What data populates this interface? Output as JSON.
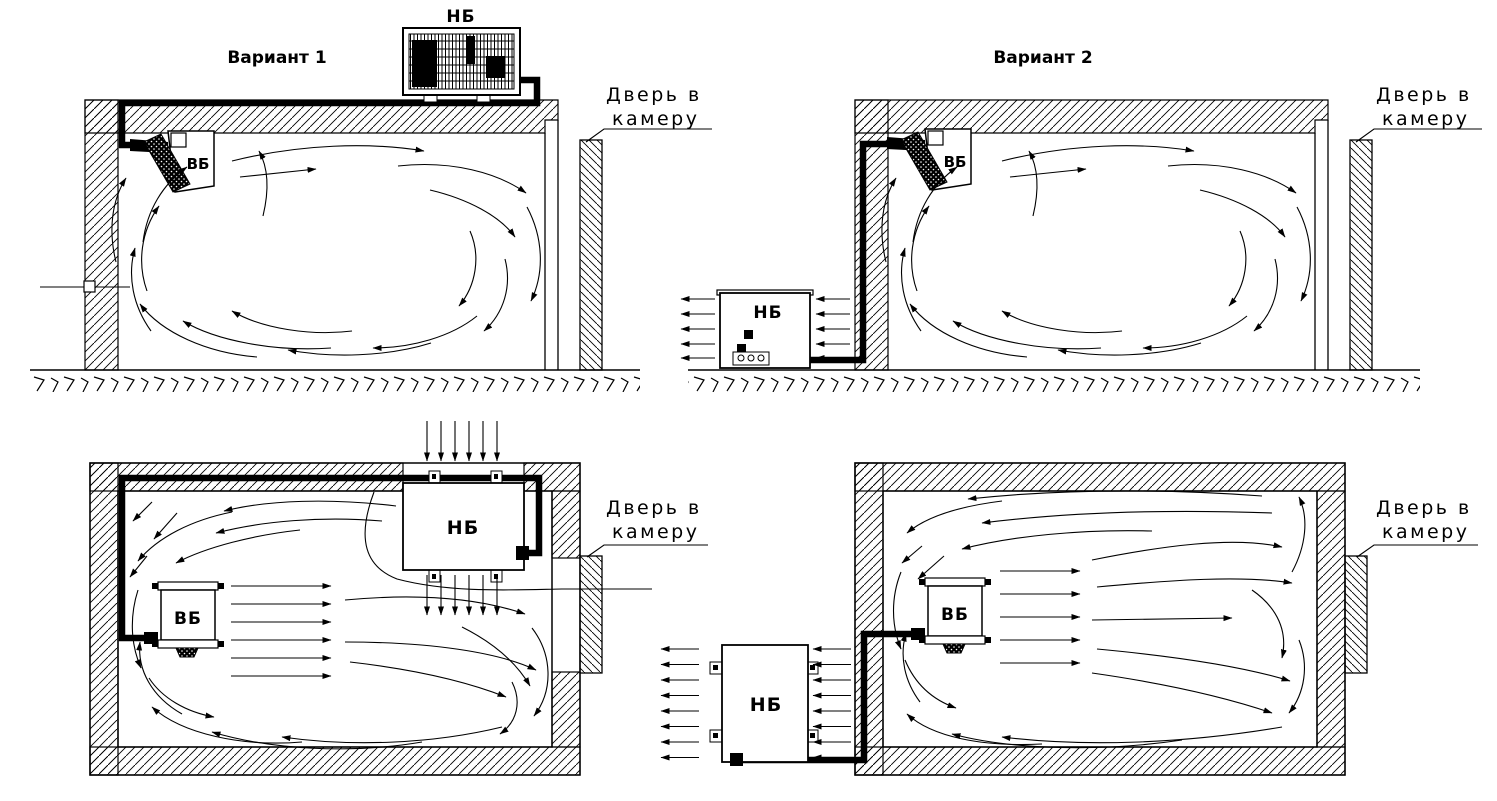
{
  "canvas": {
    "background": "#ffffff",
    "line_color": "#000000"
  },
  "diagrams": [
    {
      "name": "variant-1-elevation",
      "title": "Вариант 1",
      "outdoor_unit_label": "НБ",
      "indoor_unit_label": "ВБ",
      "door_label_line1": "Дверь в",
      "door_label_line2": "камеру"
    },
    {
      "name": "variant-2-elevation",
      "title": "Вариант 2",
      "outdoor_unit_label": "НБ",
      "indoor_unit_label": "ВБ",
      "door_label_line1": "Дверь в",
      "door_label_line2": "камеру"
    },
    {
      "name": "variant-1-plan",
      "outdoor_unit_label": "НБ",
      "indoor_unit_label": "ВБ",
      "door_label_line1": "Дверь в",
      "door_label_line2": "камеру"
    },
    {
      "name": "variant-2-plan",
      "outdoor_unit_label": "НБ",
      "indoor_unit_label": "ВБ",
      "door_label_line1": "Дверь в",
      "door_label_line2": "камеру"
    }
  ]
}
